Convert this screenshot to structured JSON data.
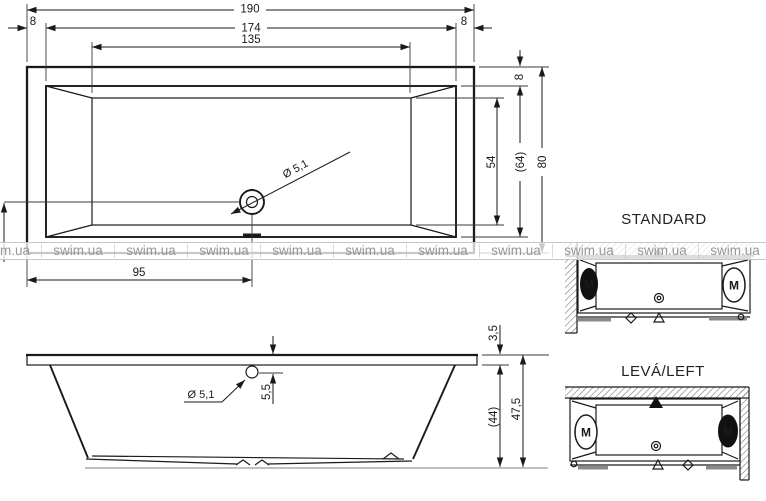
{
  "colors": {
    "line": "#1a1a1a",
    "watermark_text": "#979797",
    "gray_bar": "#8a8a8a",
    "floor_line": "#9a9a9a"
  },
  "watermark": {
    "items": [
      "m.ua",
      "swim.ua",
      "swim.ua",
      "swim.ua",
      "swim.ua",
      "swim.ua",
      "swim.ua",
      "swim.ua",
      "swim.ua",
      "swim.ua",
      "swim.ua"
    ]
  },
  "top_view": {
    "dim_total_length": "190",
    "dim_rim_left": "8",
    "dim_inner_length": "174",
    "dim_basin_length": "135",
    "dim_rim_right": "8",
    "dim_rim_top": "8",
    "dim_basin_width": "54",
    "dim_inner_width": "(64)",
    "dim_total_width": "80",
    "dim_drain_offset": "95",
    "drain_label": "Ø 5,1"
  },
  "side_view": {
    "drain_label": "Ø 5,1",
    "dim_drain_below_rim": "5,5",
    "dim_rim_thickness": "3,5",
    "dim_inner_depth": "(44)",
    "dim_total_height": "47,5"
  },
  "variants": {
    "standard": {
      "title": "STANDARD",
      "motor_left": "M",
      "motor_right": "M"
    },
    "left": {
      "title": "LEVÁ/LEFT",
      "motor_left": "M",
      "motor_right": "M"
    }
  }
}
